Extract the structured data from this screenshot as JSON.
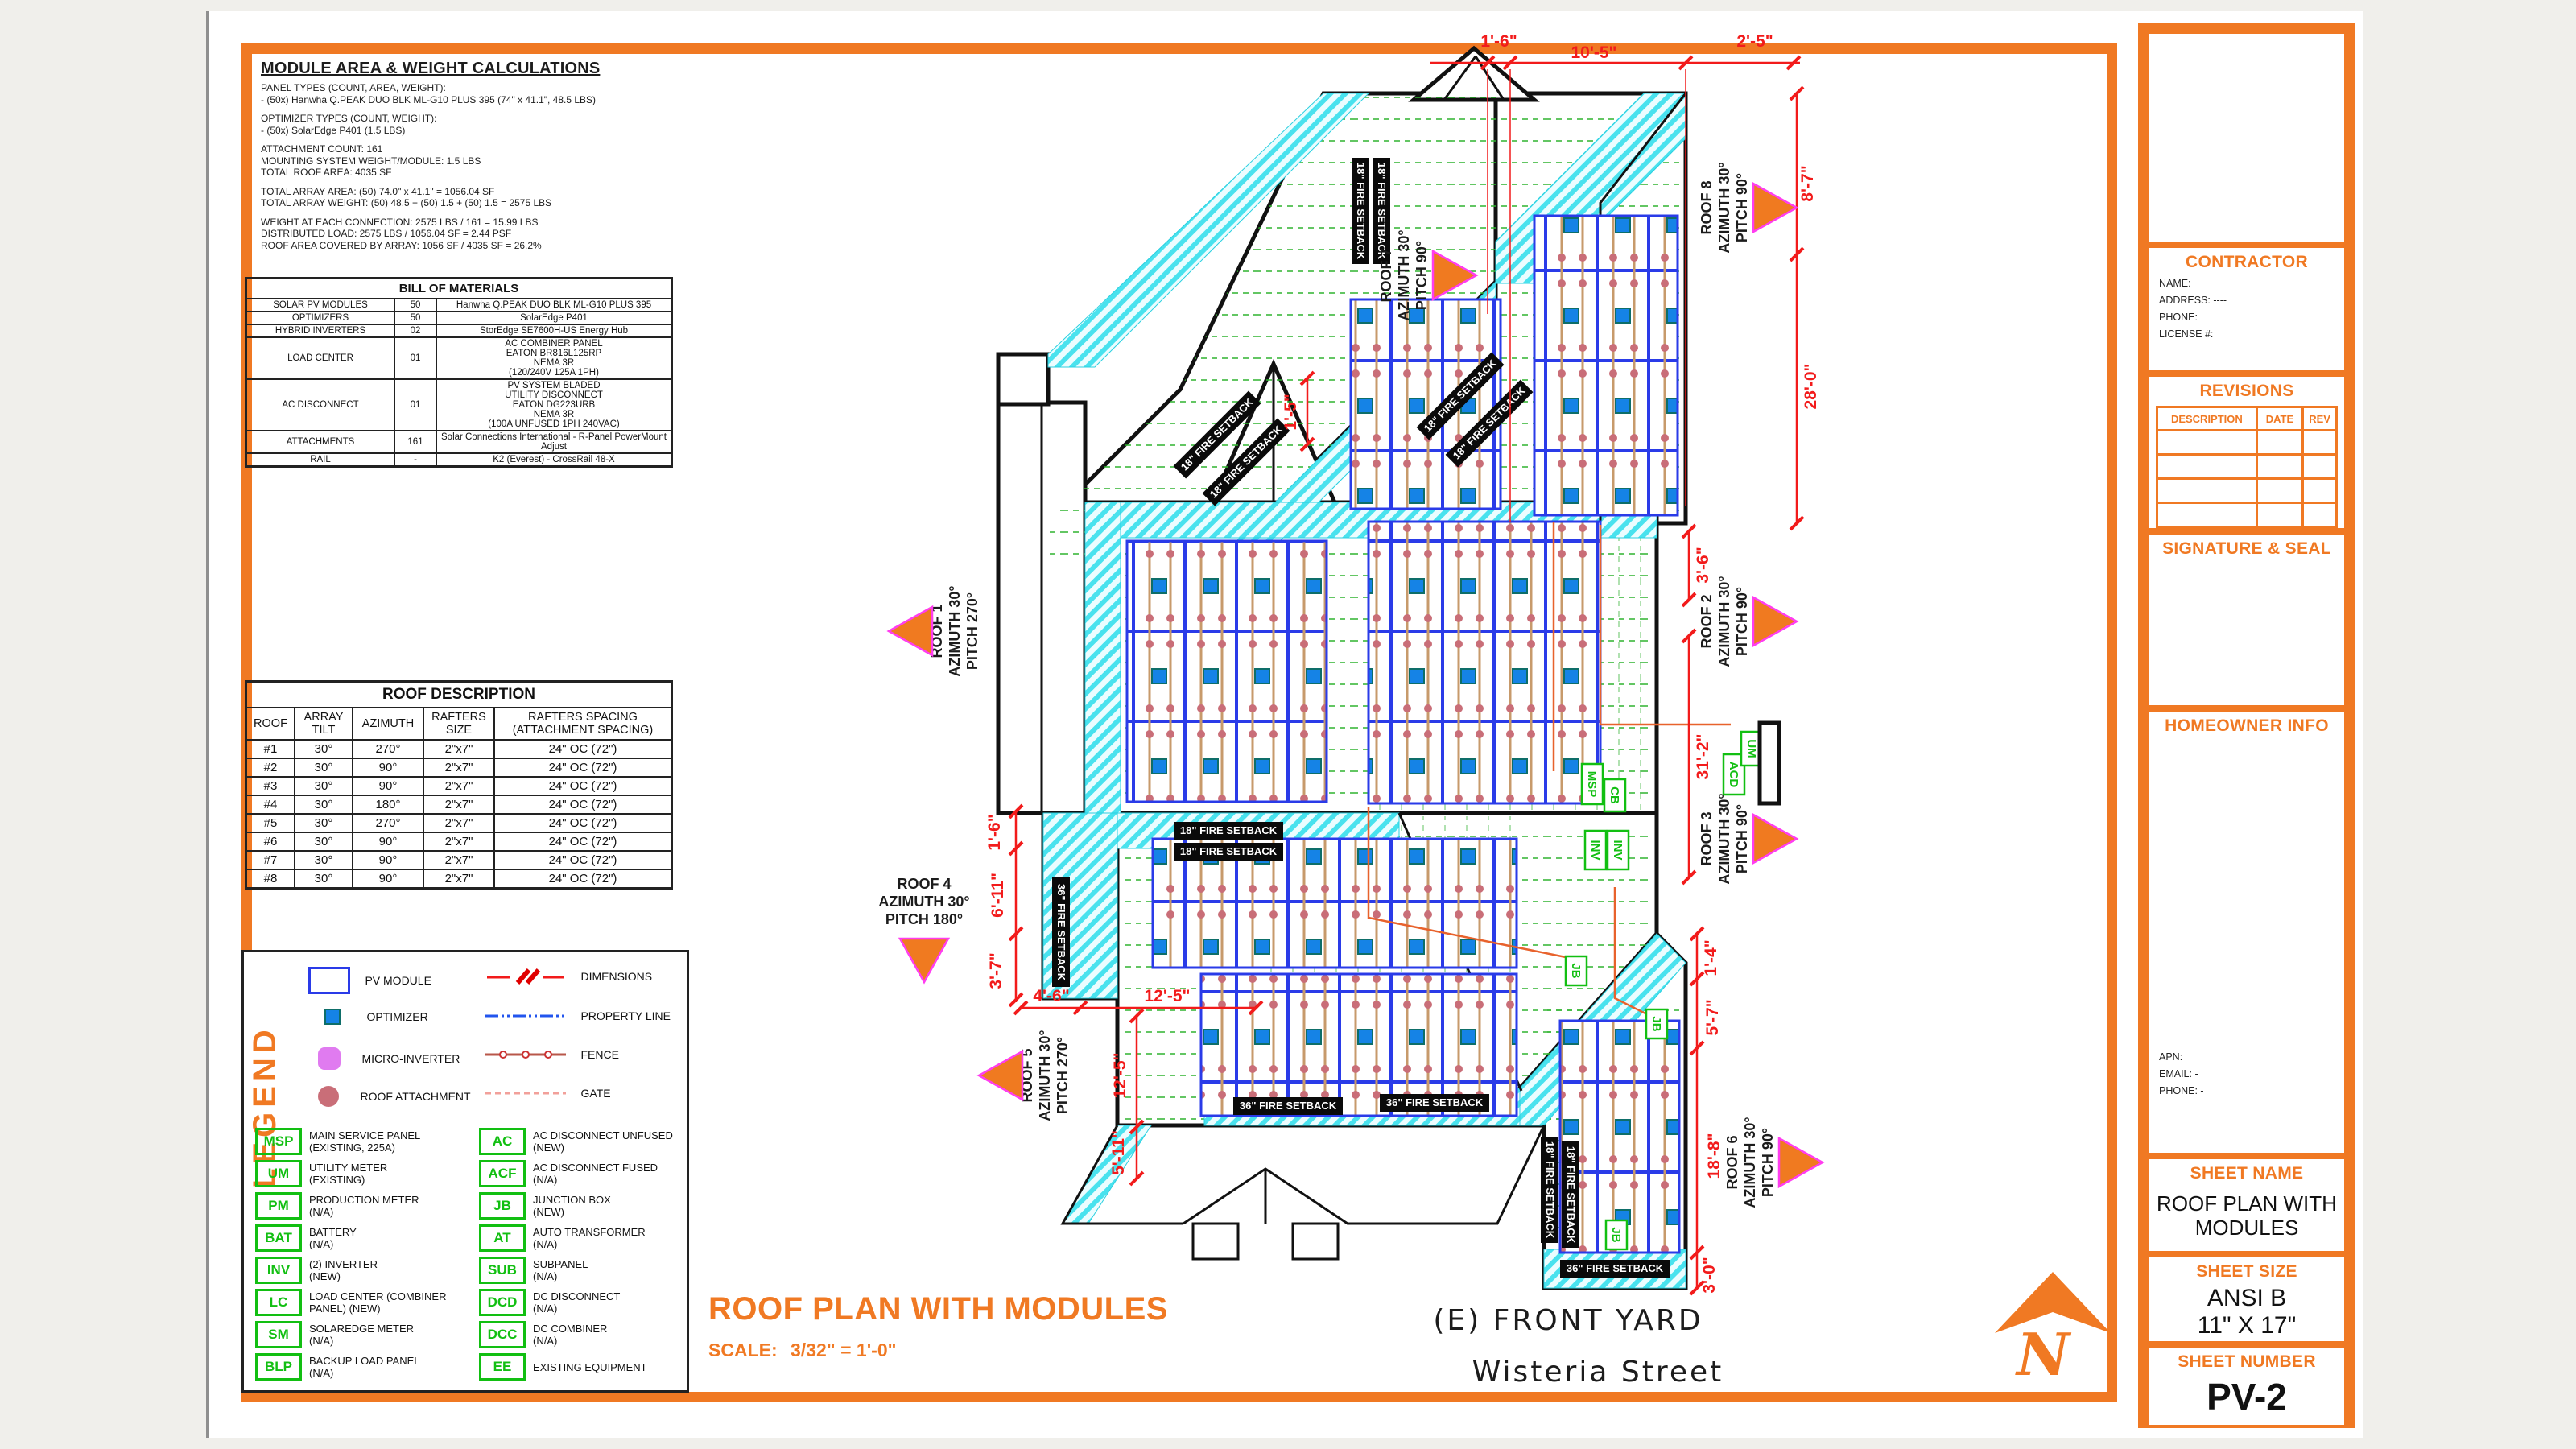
{
  "notes": {
    "title": "MODULE AREA & WEIGHT CALCULATIONS",
    "lines": [
      "PANEL TYPES (COUNT, AREA, WEIGHT):",
      "- (50x) Hanwha Q.PEAK DUO BLK ML-G10 PLUS 395 (74\" x 41.1\", 48.5 LBS)",
      "",
      "OPTIMIZER TYPES (COUNT, WEIGHT):",
      "- (50x) SolarEdge P401 (1.5 LBS)",
      "",
      "ATTACHMENT COUNT: 161",
      "MOUNTING SYSTEM WEIGHT/MODULE: 1.5 LBS",
      "TOTAL ROOF AREA: 4035 SF",
      "",
      "TOTAL ARRAY AREA: (50) 74.0\" x 41.1\" = 1056.04 SF",
      "TOTAL ARRAY WEIGHT: (50) 48.5 + (50) 1.5 + (50) 1.5 = 2575 LBS",
      "",
      "WEIGHT AT EACH CONNECTION: 2575 LBS / 161 = 15.99 LBS",
      "DISTRIBUTED LOAD: 2575 LBS / 1056.04 SF = 2.44 PSF",
      "ROOF AREA COVERED BY ARRAY: 1056 SF / 4035 SF = 26.2%"
    ]
  },
  "bom": {
    "title": "BILL OF MATERIALS",
    "rows": [
      {
        "item": "SOLAR PV MODULES",
        "qty": "50",
        "desc": [
          "Hanwha Q.PEAK DUO BLK ML-G10 PLUS 395"
        ]
      },
      {
        "item": "OPTIMIZERS",
        "qty": "50",
        "desc": [
          "SolarEdge P401"
        ]
      },
      {
        "item": "HYBRID INVERTERS",
        "qty": "02",
        "desc": [
          "StorEdge SE7600H-US Energy Hub"
        ]
      },
      {
        "item": "LOAD CENTER",
        "qty": "01",
        "desc": [
          "AC COMBINER PANEL",
          "EATON BR816L125RP",
          "NEMA 3R",
          "(120/240V 125A 1PH)"
        ]
      },
      {
        "item": "AC DISCONNECT",
        "qty": "01",
        "desc": [
          "PV SYSTEM BLADED",
          "UTILITY DISCONNECT",
          "EATON DG223URB",
          "NEMA 3R",
          "(100A UNFUSED 1PH 240VAC)"
        ]
      },
      {
        "item": "ATTACHMENTS",
        "qty": "161",
        "desc": [
          "Solar Connections International - R-Panel PowerMount Adjust"
        ]
      },
      {
        "item": "RAIL",
        "qty": "-",
        "desc": [
          "K2 (Everest) - CrossRail 48-X"
        ]
      }
    ]
  },
  "roof_table": {
    "title": "ROOF DESCRIPTION",
    "headers": [
      "ROOF",
      "ARRAY TILT",
      "AZIMUTH",
      "RAFTERS SIZE",
      "RAFTERS SPACING (ATTACHMENT SPACING)"
    ],
    "rows": [
      {
        "roof": "#1",
        "tilt": "30°",
        "azimuth": "270°",
        "size": "2\"x7\"",
        "spacing": "24\" OC (72\")"
      },
      {
        "roof": "#2",
        "tilt": "30°",
        "azimuth": "90°",
        "size": "2\"x7\"",
        "spacing": "24\" OC (72\")"
      },
      {
        "roof": "#3",
        "tilt": "30°",
        "azimuth": "90°",
        "size": "2\"x7\"",
        "spacing": "24\" OC (72\")"
      },
      {
        "roof": "#4",
        "tilt": "30°",
        "azimuth": "180°",
        "size": "2\"x7\"",
        "spacing": "24\" OC (72\")"
      },
      {
        "roof": "#5",
        "tilt": "30°",
        "azimuth": "270°",
        "size": "2\"x7\"",
        "spacing": "24\" OC (72\")"
      },
      {
        "roof": "#6",
        "tilt": "30°",
        "azimuth": "90°",
        "size": "2\"x7\"",
        "spacing": "24\" OC (72\")"
      },
      {
        "roof": "#7",
        "tilt": "30°",
        "azimuth": "90°",
        "size": "2\"x7\"",
        "spacing": "24\" OC (72\")"
      },
      {
        "roof": "#8",
        "tilt": "30°",
        "azimuth": "90°",
        "size": "2\"x7\"",
        "spacing": "24\" OC (72\")"
      }
    ]
  },
  "legend": {
    "title": "LEGEND",
    "symbols": [
      {
        "icon": "pv-module",
        "label": "PV MODULE"
      },
      {
        "icon": "optimizer",
        "label": "OPTIMIZER"
      },
      {
        "icon": "micro-inverter",
        "label": "MICRO-INVERTER"
      },
      {
        "icon": "roof-attachment",
        "label": "ROOF ATTACHMENT"
      }
    ],
    "lines": [
      {
        "icon": "dimensions",
        "label": "DIMENSIONS"
      },
      {
        "icon": "property-line",
        "label": "PROPERTY LINE"
      },
      {
        "icon": "fence",
        "label": "FENCE"
      },
      {
        "icon": "gate",
        "label": "GATE"
      }
    ],
    "tags": [
      {
        "abbr": "MSP",
        "line1": "MAIN SERVICE PANEL",
        "line2": "(EXISTING, 225A)"
      },
      {
        "abbr": "AC",
        "line1": "AC DISCONNECT UNFUSED",
        "line2": "(NEW)"
      },
      {
        "abbr": "UM",
        "line1": "UTILITY METER",
        "line2": "(EXISTING)"
      },
      {
        "abbr": "ACF",
        "line1": "AC DISCONNECT FUSED",
        "line2": "(N/A)"
      },
      {
        "abbr": "PM",
        "line1": "PRODUCTION METER",
        "line2": "(N/A)"
      },
      {
        "abbr": "JB",
        "line1": "JUNCTION BOX",
        "line2": "(NEW)"
      },
      {
        "abbr": "BAT",
        "line1": "BATTERY",
        "line2": "(N/A)"
      },
      {
        "abbr": "AT",
        "line1": "AUTO TRANSFORMER",
        "line2": "(N/A)"
      },
      {
        "abbr": "INV",
        "line1": "(2)  INVERTER",
        "line2": "(NEW)"
      },
      {
        "abbr": "SUB",
        "line1": "SUBPANEL",
        "line2": "(N/A)"
      },
      {
        "abbr": "LC",
        "line1": "LOAD CENTER (COMBINER",
        "line2": "PANEL) (NEW)"
      },
      {
        "abbr": "DCD",
        "line1": "DC DISCONNECT",
        "line2": "(N/A)"
      },
      {
        "abbr": "SM",
        "line1": "SOLAREDGE METER",
        "line2": "(N/A)"
      },
      {
        "abbr": "DCC",
        "line1": "DC COMBINER",
        "line2": "(N/A)"
      },
      {
        "abbr": "BLP",
        "line1": "BACKUP LOAD PANEL",
        "line2": "(N/A)"
      },
      {
        "abbr": "EE",
        "line1": "EXISTING EQUIPMENT",
        "line2": ""
      }
    ]
  },
  "drawing_title": {
    "title": "ROOF PLAN WITH MODULES",
    "scale_label": "SCALE:",
    "scale_value": "3/32\" = 1'-0\""
  },
  "plan": {
    "setback18": "18\" FIRE SETBACK",
    "setback36": "36\" FIRE SETBACK",
    "front_yard": "(E) FRONT YARD",
    "street": "Wisteria Street",
    "north_label": "N",
    "dims": [
      "1'-6\"",
      "10'-5\"",
      "2'-5\"",
      "8'-7\"",
      "28'-0\"",
      "3'-6\"",
      "31'-2\"",
      "1'-4\"",
      "5'-7\"",
      "18'-8\"",
      "3'-0\"",
      "1'-6\"",
      "6'-11\"",
      "3'-7\"",
      "4'-6\"",
      "12'-5\"",
      "12'-5\"",
      "5'-11\"",
      "1'-5\""
    ],
    "roofs": [
      {
        "name": "ROOF 1",
        "azimuth": "AZIMUTH 30°",
        "pitch": "PITCH 270°"
      },
      {
        "name": "ROOF 2",
        "azimuth": "AZIMUTH 30°",
        "pitch": "PITCH 90°"
      },
      {
        "name": "ROOF 3",
        "azimuth": "AZIMUTH 30°",
        "pitch": "PITCH 90°"
      },
      {
        "name": "ROOF 4",
        "azimuth": "AZIMUTH 30°",
        "pitch": "PITCH 180°"
      },
      {
        "name": "ROOF 5",
        "azimuth": "AZIMUTH 30°",
        "pitch": "PITCH 270°"
      },
      {
        "name": "ROOF 6",
        "azimuth": "AZIMUTH 30°",
        "pitch": "PITCH 90°"
      },
      {
        "name": "ROOF 7",
        "azimuth": "AZIMUTH 30°",
        "pitch": "PITCH 90°"
      },
      {
        "name": "ROOF 8",
        "azimuth": "AZIMUTH 30°",
        "pitch": "PITCH 90°"
      }
    ],
    "equipment": [
      "MSP",
      "CB",
      "INV",
      "INV",
      "ACD",
      "UM",
      "JB",
      "JB",
      "JB"
    ]
  },
  "titleblock": {
    "contractor": {
      "title": "CONTRACTOR",
      "fields": [
        {
          "label": "NAME:",
          "value": ""
        },
        {
          "label": "ADDRESS:",
          "value": "----"
        },
        {
          "label": "PHONE:",
          "value": ""
        },
        {
          "label": "LICENSE #:",
          "value": ""
        }
      ]
    },
    "revisions": {
      "title": "REVISIONS",
      "headers": [
        "DESCRIPTION",
        "DATE",
        "REV"
      ]
    },
    "signature": {
      "title": "SIGNATURE & SEAL"
    },
    "homeowner": {
      "title": "HOMEOWNER INFO",
      "fields": [
        {
          "label": "APN:",
          "value": ""
        },
        {
          "label": "EMAIL:",
          "value": "-"
        },
        {
          "label": "PHONE:",
          "value": "-"
        }
      ]
    },
    "sheet_name": {
      "title": "SHEET NAME",
      "line1": "ROOF PLAN WITH",
      "line2": "MODULES"
    },
    "sheet_size": {
      "title": "SHEET SIZE",
      "line1": "ANSI B",
      "line2": "11\" X 17\""
    },
    "sheet_number": {
      "title": "SHEET NUMBER",
      "value": "PV-2"
    }
  },
  "colors": {
    "accent": "#F07923",
    "dim_red": "#F21B1B",
    "setback_cyan": "#49E2EE",
    "equip_green": "#12BF12",
    "module_blue": "#2A3BE8",
    "attachment": "#C96E78"
  }
}
